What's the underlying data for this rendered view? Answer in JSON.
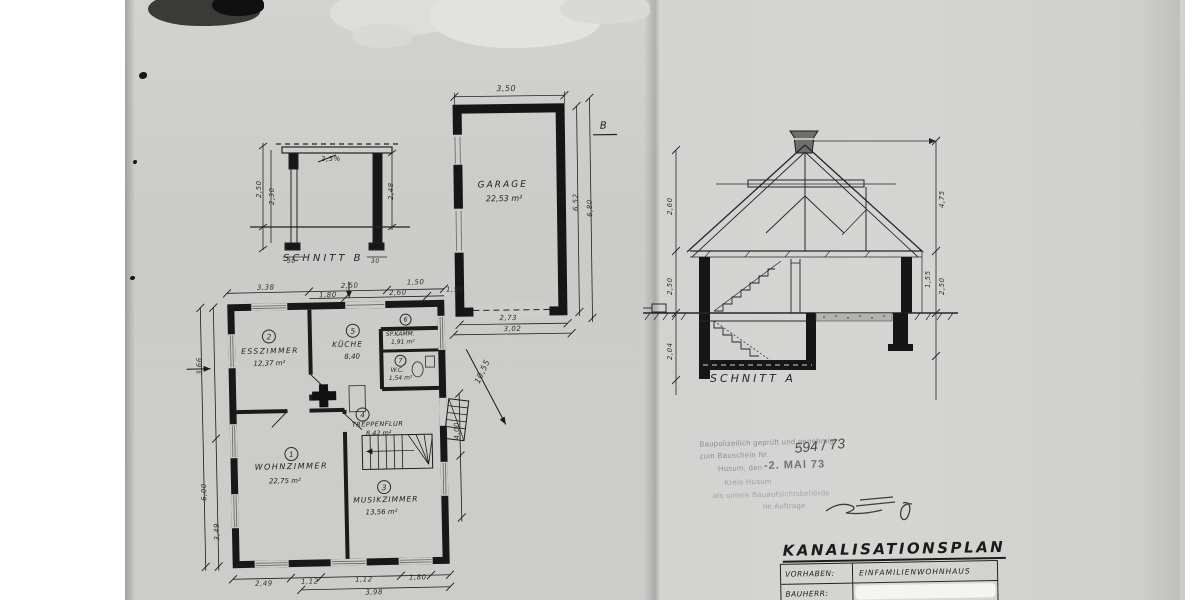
{
  "schnitt_b": {
    "label": "SCHNITT B",
    "slope": "2,5%",
    "dim_left_outer": "2,50",
    "dim_left_inner": "2,30",
    "dim_right": "2,48",
    "dim_foot_left": "30",
    "dim_foot_right": "30"
  },
  "garage": {
    "label": "GARAGE",
    "area": "22,53 m²",
    "marker": "B",
    "dim_top": "3,50",
    "dim_right_inner": "6,52",
    "dim_right_outer": "6,80",
    "dim_bottom_inner": "2,73",
    "dim_bottom_outer": "3,02"
  },
  "schnitt_a": {
    "label": "SCHNITT A",
    "dim_left_roof": "2,60",
    "dim_left_floor": "2,50",
    "dim_left_cellar": "2,04",
    "dim_right_ridge": "4,75",
    "dim_right_knee": "1,55",
    "dim_right_floor": "2,50"
  },
  "plan": {
    "rooms": [
      {
        "no": "1",
        "name": "WOHNZIMMER",
        "area": "22,75 m²"
      },
      {
        "no": "2",
        "name": "ESSZIMMER",
        "area": "12,37 m²"
      },
      {
        "no": "3",
        "name": "MUSIKZIMMER",
        "area": "13,56 m²"
      },
      {
        "no": "4",
        "name": "TREPPENFLUR",
        "area": "8,42 m²"
      },
      {
        "no": "5",
        "name": "KÜCHE",
        "area": "8,40"
      },
      {
        "no": "6",
        "name": "SP.KAMM.",
        "area": "1,91 m²"
      },
      {
        "no": "7",
        "name": "W.C.",
        "area": "1,54 m²"
      }
    ],
    "dims": {
      "top": [
        "3,38",
        "2,50",
        "1,50"
      ],
      "top_inner": [
        "1,80",
        "2,60",
        "1,50"
      ],
      "bottom": [
        "2,49",
        "1,12",
        "1,12",
        "1,80"
      ],
      "bottom_total": "3,98",
      "left": [
        "3,66",
        "6,00",
        "3,49"
      ],
      "right_vert": "4,00",
      "sewer_run": "10,55"
    }
  },
  "stamp": {
    "line1": "Baupolizeilich geprüft und genehmigt",
    "line2": "zum Bauschein Nr.",
    "number": "594 / 73",
    "line3": "Husum, den",
    "date": "-2. MAI 73",
    "line4": "Kreis Husum",
    "line5": "als untere Bauaufsichtsbehörde",
    "line6": "Im Auftrage"
  },
  "title_block": {
    "title": "KANALISATIONSPLAN",
    "rows": [
      {
        "key": "VORHABEN:",
        "value": "EINFAMILIENWOHNHAUS"
      },
      {
        "key": "BAUHERR:",
        "value": ""
      }
    ]
  },
  "colors": {
    "paper": "#cdcdcb",
    "ink": "#1e1e1e",
    "stamp": "#8e8e93"
  }
}
